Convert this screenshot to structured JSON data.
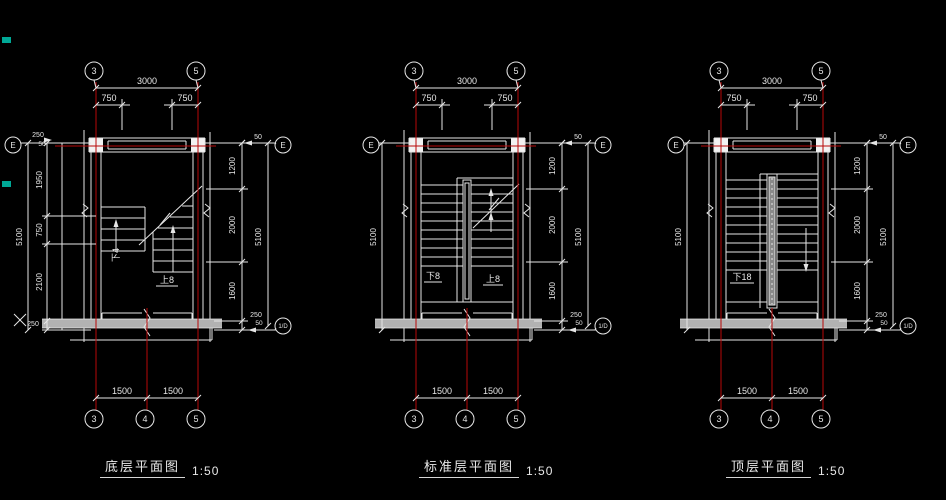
{
  "canvas": {
    "bg": "#000000"
  },
  "colors": {
    "line": "#e6e6e6",
    "grid": "#b80808",
    "wall_fill": "#b2b2b2",
    "column_fill": "#f2f2f2",
    "rail_fill": "#8a8a8a",
    "artifact": "#00a896"
  },
  "plans": [
    {
      "id": "ground",
      "title": "底层平面图",
      "scale": "1:50",
      "axes": {
        "top": [
          "3",
          "5"
        ],
        "bottom": [
          "3",
          "4",
          "5"
        ],
        "left_row": "E",
        "right_row": "E",
        "right_bottom": "1/D"
      },
      "dims": {
        "top_overall": "3000",
        "top_left": "750",
        "top_right": "750",
        "bottom_left": "1500",
        "bottom_right": "1500",
        "right_top_offset": "50",
        "right_chain": [
          "1200",
          "2000",
          "1600"
        ],
        "right_bottom_offset_a": "250",
        "right_bottom_offset_b": "50",
        "right_overall": "5100",
        "left_top_offset_a": "250",
        "left_top_offset_b": "50",
        "left_chain": [
          "1950",
          "750",
          "2100"
        ],
        "left_bottom_offset": "250",
        "left_overall": "5100"
      },
      "stair": {
        "type": "bottom",
        "down": "下4",
        "up": "上8"
      }
    },
    {
      "id": "standard",
      "title": "标准层平面图",
      "scale": "1:50",
      "axes": {
        "top": [
          "3",
          "5"
        ],
        "bottom": [
          "3",
          "4",
          "5"
        ],
        "left_row": "E",
        "right_row": "E",
        "right_bottom": "1/D"
      },
      "dims": {
        "top_overall": "3000",
        "top_left": "750",
        "top_right": "750",
        "bottom_left": "1500",
        "bottom_right": "1500",
        "right_top_offset": "50",
        "right_chain": [
          "1200",
          "2000",
          "1600"
        ],
        "right_bottom_offset_a": "250",
        "right_bottom_offset_b": "50",
        "right_overall": "5100",
        "left_overall": "5100"
      },
      "stair": {
        "type": "middle",
        "down": "下8",
        "up": "上8"
      }
    },
    {
      "id": "top",
      "title": "顶层平面图",
      "scale": "1:50",
      "axes": {
        "top": [
          "3",
          "5"
        ],
        "bottom": [
          "3",
          "4",
          "5"
        ],
        "left_row": "E",
        "right_row": "E",
        "right_bottom": "1/D"
      },
      "dims": {
        "top_overall": "3000",
        "top_left": "750",
        "top_right": "750",
        "bottom_left": "1500",
        "bottom_right": "1500",
        "right_top_offset": "50",
        "right_chain": [
          "1200",
          "2000",
          "1600"
        ],
        "right_bottom_offset_a": "250",
        "right_bottom_offset_b": "50",
        "right_overall": "5100",
        "left_overall": "5100"
      },
      "stair": {
        "type": "top",
        "down": "下18"
      }
    }
  ]
}
